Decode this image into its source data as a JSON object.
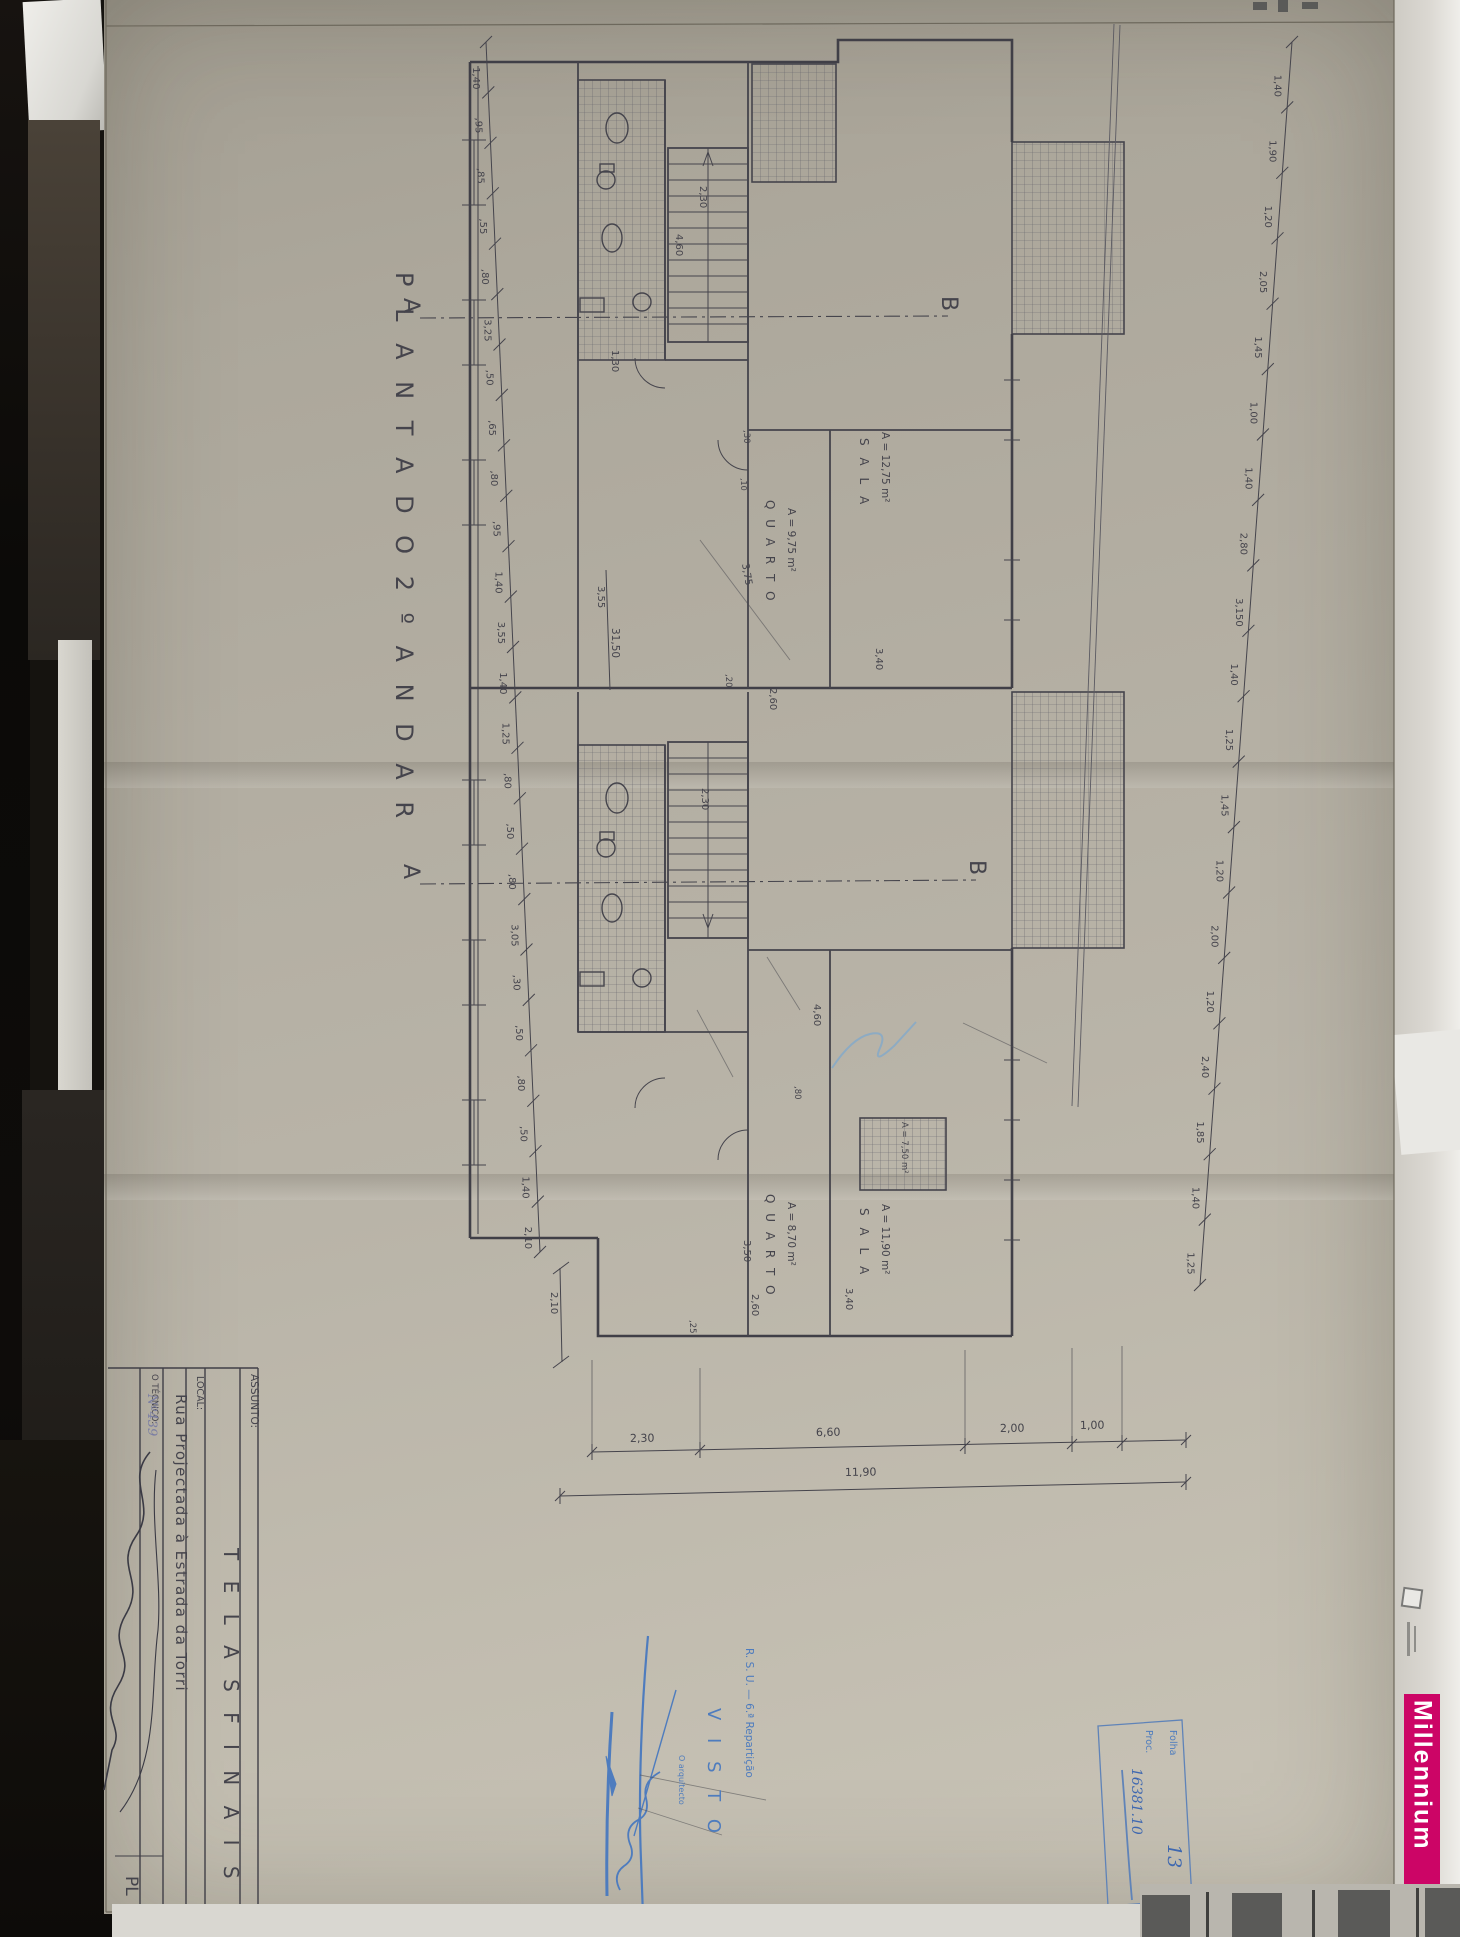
{
  "photo": {
    "millennium": {
      "text": "Millennium",
      "color": "#cc0566"
    },
    "paper_color": "#b3aea2",
    "ink_color": "#45444c",
    "stamp_blue": "#4e7cbe"
  },
  "sheet": {
    "title": "P L A N T A   D O   2 º   A N D A R",
    "title_block": {
      "assunto_label": "ASSUNTO:",
      "assunto_value": "T E L A S    F I N A I S",
      "local_label": "LOCAL:",
      "local_value": "Rua Projectada à Estrada da Torri",
      "tecnico_label": "O TÉCNICO:",
      "tecnico_number": "Nº439",
      "sheet_code": "PL"
    },
    "stamps": {
      "visto_line1": "R. S. U. — 6.ª Repartição",
      "visto_line2": "V I S T O",
      "visto_line3": "O arquitecto",
      "folha_label": "Folha",
      "proc_label": "Proc.",
      "folha_value": "13",
      "proc_value": "16381.10"
    }
  },
  "plan": {
    "labels": [
      {
        "n": "plan-title",
        "t": "P L A N T A   D O   2 º   A N D A R",
        "x": 396,
        "y": 272,
        "r": 90,
        "s": 24,
        "ls": 7
      },
      {
        "n": "section-marker-a-top",
        "t": "A",
        "x": 404,
        "y": 298,
        "r": 90,
        "s": 22
      },
      {
        "n": "section-marker-b-top",
        "t": "B",
        "x": 942,
        "y": 296,
        "r": 90,
        "s": 22
      },
      {
        "n": "section-marker-a-bottom",
        "t": "A",
        "x": 404,
        "y": 864,
        "r": 90,
        "s": 22
      },
      {
        "n": "section-marker-b-bottom",
        "t": "B",
        "x": 970,
        "y": 860,
        "r": 90,
        "s": 22
      },
      {
        "n": "room-quarto-1",
        "t": "Q U A R T O",
        "x": 766,
        "y": 500,
        "r": 90,
        "s": 12,
        "ls": 3
      },
      {
        "n": "room-quarto-1-area",
        "t": "A = 9,75 m²",
        "x": 788,
        "y": 508,
        "r": 90,
        "s": 10.5
      },
      {
        "n": "dim",
        "t": "3,75",
        "x": 742,
        "y": 564,
        "r": 80,
        "s": 10
      },
      {
        "n": "room-sala-1",
        "t": "S A L A",
        "x": 860,
        "y": 438,
        "r": 90,
        "s": 12,
        "ls": 4
      },
      {
        "n": "room-sala-1-area",
        "t": "A = 12,75 m²",
        "x": 882,
        "y": 432,
        "r": 90,
        "s": 10.5
      },
      {
        "n": "dim",
        "t": "2,60",
        "x": 770,
        "y": 688,
        "r": 90,
        "s": 10
      },
      {
        "n": "dim",
        "t": ",20",
        "x": 726,
        "y": 674,
        "r": 90,
        "s": 8.5
      },
      {
        "n": "dim",
        "t": "3,40",
        "x": 876,
        "y": 648,
        "r": 90,
        "s": 10
      },
      {
        "n": "dim",
        "t": ",30",
        "x": 744,
        "y": 430,
        "r": 90,
        "s": 8.5
      },
      {
        "n": "dim",
        "t": ",10",
        "x": 741,
        "y": 478,
        "r": 90,
        "s": 8
      },
      {
        "n": "dim",
        "t": "1,30",
        "x": 612,
        "y": 350,
        "r": 90,
        "s": 10
      },
      {
        "n": "dim-stair-width",
        "t": "2,30",
        "x": 700,
        "y": 186,
        "r": 90,
        "s": 10
      },
      {
        "n": "dim-stair-length",
        "t": "4,60",
        "x": 676,
        "y": 234,
        "r": 90,
        "s": 10
      },
      {
        "n": "room-quarto-2",
        "t": "Q U A R T O",
        "x": 766,
        "y": 1194,
        "r": 90,
        "s": 12,
        "ls": 3
      },
      {
        "n": "room-quarto-2-area",
        "t": "A = 8,70 m²",
        "x": 788,
        "y": 1202,
        "r": 90,
        "s": 10.5
      },
      {
        "n": "dim",
        "t": "3,50",
        "x": 744,
        "y": 1240,
        "r": 90,
        "s": 10
      },
      {
        "n": "room-sala-2",
        "t": "S A L A",
        "x": 860,
        "y": 1208,
        "r": 90,
        "s": 12,
        "ls": 4
      },
      {
        "n": "room-sala-2-area",
        "t": "A = 11,90 m²",
        "x": 882,
        "y": 1204,
        "r": 90,
        "s": 10.5
      },
      {
        "n": "dim",
        "t": "2,60",
        "x": 752,
        "y": 1294,
        "r": 90,
        "s": 10
      },
      {
        "n": "dim",
        "t": "3,40",
        "x": 846,
        "y": 1288,
        "r": 90,
        "s": 10
      },
      {
        "n": "room-balcony-area",
        "t": "A = 7,50 m²",
        "x": 902,
        "y": 1122,
        "r": 90,
        "s": 8.5
      },
      {
        "n": "dim-stair-width-2",
        "t": "2,30",
        "x": 702,
        "y": 788,
        "r": 90,
        "s": 10
      },
      {
        "n": "dim-stair-length-2",
        "t": "4,60",
        "x": 814,
        "y": 1004,
        "r": 90,
        "s": 10
      },
      {
        "n": "dim",
        "t": ",80",
        "x": 795,
        "y": 1086,
        "r": 90,
        "s": 8.5
      },
      {
        "n": "dim",
        "t": ",25",
        "x": 690,
        "y": 1320,
        "r": 90,
        "s": 8.5
      },
      {
        "n": "dim",
        "t": "2,10",
        "x": 551,
        "y": 1292,
        "r": 90,
        "s": 10
      },
      {
        "n": "dim",
        "t": "3,55",
        "x": 598,
        "y": 586,
        "r": 90,
        "s": 10
      },
      {
        "n": "dim-total-length",
        "t": "31,50",
        "x": 612,
        "y": 628,
        "r": 90,
        "s": 10.5
      },
      {
        "n": "dim-bottom",
        "t": "2,30",
        "x": 630,
        "y": 1442,
        "r": -1,
        "s": 11
      },
      {
        "n": "dim-bottom",
        "t": "6,60",
        "x": 816,
        "y": 1436,
        "r": -1,
        "s": 11
      },
      {
        "n": "dim-bottom",
        "t": "2,00",
        "x": 1000,
        "y": 1432,
        "r": -1,
        "s": 11
      },
      {
        "n": "dim-bottom",
        "t": "1,00",
        "x": 1080,
        "y": 1429,
        "r": -1,
        "s": 11
      },
      {
        "n": "dim-bottom-total",
        "t": "11,90",
        "x": 845,
        "y": 1476,
        "r": -1,
        "s": 11
      },
      {
        "n": "titleblock-assunto-label",
        "t": "ASSUNTO:",
        "x": 251,
        "y": 1374,
        "r": 90,
        "s": 10.5
      },
      {
        "n": "titleblock-assunto-value",
        "t": "T E L A S    F I N A I S",
        "x": 224,
        "y": 1548,
        "r": 90,
        "s": 20,
        "ls": 7
      },
      {
        "n": "titleblock-local-label",
        "t": "LOCAL:",
        "x": 197,
        "y": 1376,
        "r": 90,
        "s": 9.5
      },
      {
        "n": "titleblock-local-value",
        "t": "Rua Projectada à Estrada da Torri",
        "x": 176,
        "y": 1394,
        "r": 90,
        "s": 15,
        "ls": 1.5
      },
      {
        "n": "titleblock-tecnico-label",
        "t": "O TÉCNICO:",
        "x": 152,
        "y": 1374,
        "r": 90,
        "s": 8.5
      },
      {
        "n": "titleblock-tecnico-number",
        "t": "Nº439",
        "x": 148,
        "y": 1394,
        "r": 90,
        "s": 13,
        "c": "pencil"
      },
      {
        "n": "titleblock-sheet-code",
        "t": "PL",
        "x": 126,
        "y": 1876,
        "r": 90,
        "s": 17
      },
      {
        "n": "stamp-rsu",
        "t": "R. S. U. — 6.ª Repartição",
        "x": 746,
        "y": 1648,
        "r": 90,
        "s": 10.5,
        "c": "blue"
      },
      {
        "n": "stamp-visto",
        "t": "V I S T O",
        "x": 708,
        "y": 1708,
        "r": 90,
        "s": 18,
        "ls": 6,
        "c": "blue"
      },
      {
        "n": "stamp-arquitecto",
        "t": "O arquitecto",
        "x": 679,
        "y": 1755,
        "r": 90,
        "s": 8,
        "c": "blue"
      },
      {
        "n": "stamp-folha-label",
        "t": "Folha",
        "x": 1170,
        "y": 1730,
        "r": 90,
        "s": 9.5,
        "c": "blue"
      },
      {
        "n": "stamp-proc-label",
        "t": "Proc.",
        "x": 1146,
        "y": 1730,
        "r": 90,
        "s": 9.5,
        "c": "blue"
      },
      {
        "n": "stamp-folha-value",
        "t": "13",
        "x": 1168,
        "y": 1844,
        "r": 90,
        "s": 19,
        "c": "inkblue"
      },
      {
        "n": "stamp-proc-value",
        "t": "16381.10",
        "x": 1132,
        "y": 1768,
        "r": 90,
        "s": 14,
        "c": "inkblue"
      }
    ],
    "chains": [
      {
        "n": "left-dimension-chain",
        "x1": 486,
        "y1": 42,
        "x2": 540,
        "y2": 1252,
        "offset": -14,
        "values": [
          "1,40",
          ",95",
          ",85",
          ",55",
          ",80",
          "3,25",
          ",50",
          ",65",
          ",80",
          ",95",
          "1,40",
          "3,55",
          "1,40",
          "1,25",
          ",80",
          ",50",
          ",80",
          "3,05",
          ",30",
          ",50",
          ",80",
          ",50",
          "1,40",
          "2,10"
        ]
      },
      {
        "n": "right-dimension-chain",
        "x1": 1292,
        "y1": 42,
        "x2": 1200,
        "y2": 1285,
        "offset": -15,
        "values": [
          "1,40",
          "1,90",
          "1,20",
          "2,05",
          "1,45",
          "1,00",
          "1,40",
          "2,80",
          "3,150",
          "1,40",
          "1,25",
          "1,45",
          "1,20",
          "2,00",
          "1,20",
          "2,40",
          "1,85",
          "1,40",
          "1,25"
        ]
      }
    ]
  }
}
